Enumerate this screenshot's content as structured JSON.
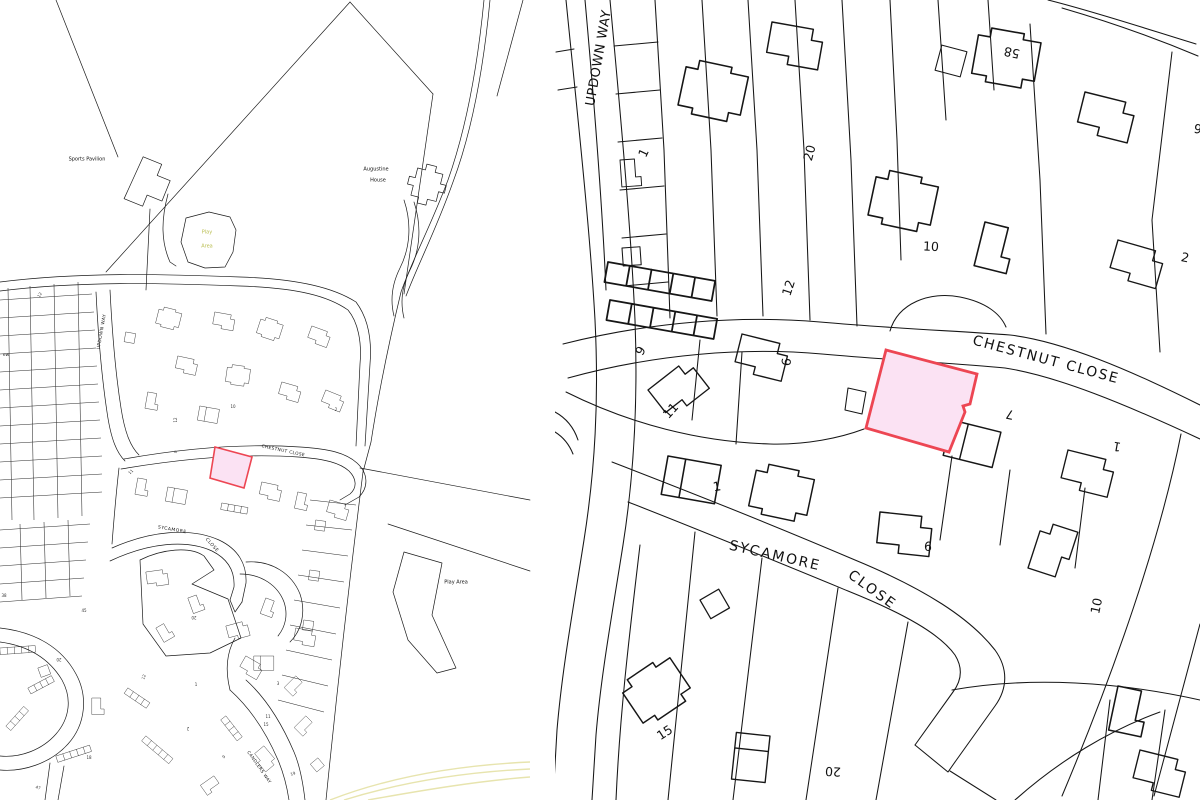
{
  "document": {
    "type": "two-panel site location and block plan"
  },
  "colors": {
    "background": "#ffffff",
    "linework": "#1b1b1b",
    "plot_fill": "#fbe2f3",
    "plot_stroke": "#ed4653",
    "play_area_text": "#b9bd4f",
    "road_accent_yellow": "#e7e4ae"
  },
  "left_panel": {
    "description": "site location plan (wide area)",
    "highlight": "pink plot on south side of Chestnut Close",
    "labels": [
      {
        "name": "poi-sports-pavilion",
        "text": "Sports Pavilion",
        "x": 87,
        "y": 160,
        "size": 5,
        "rot": 0
      },
      {
        "name": "poi-augustine-house-line1",
        "text": "Augustine",
        "x": 376,
        "y": 170,
        "size": 5,
        "rot": 0
      },
      {
        "name": "poi-augustine-house-line2",
        "text": "House",
        "x": 378,
        "y": 181,
        "size": 5,
        "rot": 0
      },
      {
        "name": "poi-play-area-north-line1",
        "text": "Play",
        "x": 207,
        "y": 233,
        "size": 5,
        "rot": 0,
        "color": "#b9bd4f"
      },
      {
        "name": "poi-play-area-north-line2",
        "text": "Area",
        "x": 207,
        "y": 247,
        "size": 5,
        "rot": 0,
        "color": "#b9bd4f"
      },
      {
        "name": "poi-play-area-east",
        "text": "Play Area",
        "x": 456,
        "y": 583,
        "size": 5,
        "rot": 0
      },
      {
        "name": "street-updown-way",
        "text": "UPDOWN WAY",
        "x": 103,
        "y": 332,
        "size": 4.5,
        "rot": -80,
        "ls": 0.4
      },
      {
        "name": "street-chestnut-close",
        "text": "CHESTNUT CLOSE",
        "x": 283,
        "y": 452,
        "size": 4.3,
        "rot": 12,
        "ls": 0.4
      },
      {
        "name": "street-sycamore",
        "text": "SYCAMORE",
        "x": 172,
        "y": 531,
        "size": 4.5,
        "rot": 10,
        "ls": 0.5
      },
      {
        "name": "street-sycamore-close",
        "text": "CLOSE",
        "x": 211,
        "y": 546,
        "size": 4.5,
        "rot": 48,
        "ls": 0.5
      },
      {
        "name": "street-candlers-way",
        "text": "CANDLERS WAY",
        "x": 258,
        "y": 768,
        "size": 4.3,
        "rot": 55,
        "ls": 0.4
      },
      {
        "name": "street-partial-edge",
        "text": "ew",
        "x": 6,
        "y": 356,
        "size": 4.5,
        "rot": 0
      },
      {
        "name": "house-number",
        "text": "10",
        "x": 233,
        "y": 407,
        "size": 4,
        "rot": 0,
        "color": "#333333"
      },
      {
        "name": "house-number",
        "text": "12",
        "x": 176,
        "y": 420,
        "size": 4,
        "rot": -90,
        "color": "#333333"
      },
      {
        "name": "house-number",
        "text": "2",
        "x": 336,
        "y": 410,
        "size": 4,
        "rot": 0,
        "color": "#333333"
      },
      {
        "name": "house-number",
        "text": "9",
        "x": 176,
        "y": 452,
        "size": 4,
        "rot": -70,
        "color": "#333333"
      },
      {
        "name": "house-number",
        "text": "11",
        "x": 131,
        "y": 472,
        "size": 4,
        "rot": -45,
        "color": "#333333"
      },
      {
        "name": "house-number",
        "text": "12",
        "x": 40,
        "y": 295,
        "size": 4,
        "rot": -60,
        "color": "#333333"
      },
      {
        "name": "house-number",
        "text": "45",
        "x": 84,
        "y": 611,
        "size": 4,
        "rot": 0,
        "color": "#333333"
      },
      {
        "name": "house-number",
        "text": "20",
        "x": 194,
        "y": 617,
        "size": 4,
        "rot": 180,
        "color": "#333333"
      },
      {
        "name": "house-number",
        "text": "38",
        "x": 4,
        "y": 596,
        "size": 4,
        "rot": 0,
        "color": "#333333"
      },
      {
        "name": "house-number",
        "text": "20",
        "x": 59,
        "y": 659,
        "size": 4,
        "rot": 180,
        "color": "#333333"
      },
      {
        "name": "house-number",
        "text": "1",
        "x": 196,
        "y": 685,
        "size": 4,
        "rot": 0,
        "color": "#333333"
      },
      {
        "name": "house-number",
        "text": "3",
        "x": 278,
        "y": 684,
        "size": 4,
        "rot": 0,
        "color": "#333333"
      },
      {
        "name": "house-number",
        "text": "12",
        "x": 144,
        "y": 677,
        "size": 4,
        "rot": -70,
        "color": "#333333"
      },
      {
        "name": "house-number",
        "text": "11",
        "x": 268,
        "y": 717,
        "size": 4,
        "rot": 0,
        "color": "#333333"
      },
      {
        "name": "house-number",
        "text": "15",
        "x": 266,
        "y": 725,
        "size": 4,
        "rot": 0,
        "color": "#333333"
      },
      {
        "name": "house-number",
        "text": "2",
        "x": 188,
        "y": 728,
        "size": 4,
        "rot": 180,
        "color": "#333333"
      },
      {
        "name": "house-number",
        "text": "9",
        "x": 224,
        "y": 757,
        "size": 4,
        "rot": -40,
        "color": "#333333"
      },
      {
        "name": "house-number",
        "text": "19",
        "x": 293,
        "y": 774,
        "size": 4,
        "rot": -20,
        "color": "#333333"
      },
      {
        "name": "house-number",
        "text": "18",
        "x": 89,
        "y": 758,
        "size": 4,
        "rot": 0,
        "color": "#333333"
      },
      {
        "name": "house-number",
        "text": "47",
        "x": 38,
        "y": 788,
        "size": 4,
        "rot": 15,
        "color": "#333333"
      }
    ]
  },
  "right_panel": {
    "description": "enlarged block plan",
    "highlight": "pink plot on south side of Chestnut Close",
    "labels": [
      {
        "name": "street-updown-way",
        "text": "UPDOWN WAY",
        "x": 599,
        "y": 58,
        "size": 13,
        "rot": -80,
        "ls": 0.5
      },
      {
        "name": "street-chestnut-close",
        "text": "CHESTNUT CLOSE",
        "x": 1046,
        "y": 360,
        "size": 14,
        "rot": 15,
        "ls": 1.8
      },
      {
        "name": "street-sycamore",
        "text": "SYCAMORE",
        "x": 775,
        "y": 556,
        "size": 14,
        "rot": 13,
        "ls": 2
      },
      {
        "name": "street-sycamore-close",
        "text": "CLOSE",
        "x": 872,
        "y": 590,
        "size": 14,
        "rot": 36,
        "ls": 2
      },
      {
        "name": "house-number",
        "text": "1",
        "x": 644,
        "y": 153,
        "size": 12.5,
        "rot": -65
      },
      {
        "name": "house-number",
        "text": "20",
        "x": 810,
        "y": 153,
        "size": 12.5,
        "rot": -75
      },
      {
        "name": "house-number",
        "text": "58",
        "x": 1012,
        "y": 52,
        "size": 12.5,
        "rot": 192
      },
      {
        "name": "house-number",
        "text": "10",
        "x": 931,
        "y": 247,
        "size": 12.5,
        "rot": 3
      },
      {
        "name": "house-number",
        "text": "12",
        "x": 789,
        "y": 288,
        "size": 12.5,
        "rot": -72
      },
      {
        "name": "house-number",
        "text": "2",
        "x": 1185,
        "y": 258,
        "size": 12.5,
        "rot": 12
      },
      {
        "name": "house-number",
        "text": "9",
        "x": 641,
        "y": 351,
        "size": 12.5,
        "rot": -60
      },
      {
        "name": "house-number",
        "text": "6",
        "x": 787,
        "y": 362,
        "size": 12.5,
        "rot": -82
      },
      {
        "name": "house-number",
        "text": "11",
        "x": 671,
        "y": 411,
        "size": 12.5,
        "rot": -48
      },
      {
        "name": "house-number",
        "text": "7",
        "x": 1010,
        "y": 414,
        "size": 12.5,
        "rot": 192
      },
      {
        "name": "house-number",
        "text": "1",
        "x": 1117,
        "y": 446,
        "size": 12.5,
        "rot": 190
      },
      {
        "name": "house-number",
        "text": "1",
        "x": 717,
        "y": 487,
        "size": 12.5,
        "rot": -10
      },
      {
        "name": "house-number",
        "text": "6",
        "x": 928,
        "y": 547,
        "size": 12.5,
        "rot": 2
      },
      {
        "name": "house-number",
        "text": "10",
        "x": 1097,
        "y": 606,
        "size": 12.5,
        "rot": -78
      },
      {
        "name": "house-number",
        "text": "15",
        "x": 665,
        "y": 733,
        "size": 12.5,
        "rot": -33
      },
      {
        "name": "house-number",
        "text": "20",
        "x": 833,
        "y": 771,
        "size": 12.5,
        "rot": 183
      },
      {
        "name": "house-number",
        "text": "6",
        "x": 1198,
        "y": 128,
        "size": 12.5,
        "rot": 190
      }
    ]
  }
}
